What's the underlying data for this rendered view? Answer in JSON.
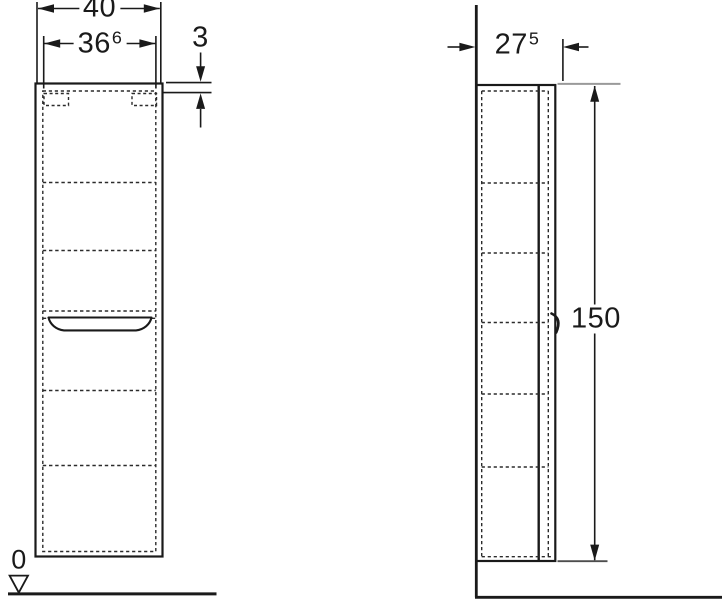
{
  "drawing": {
    "type": "furniture-technical-drawing",
    "colors": {
      "line": "#1a1a1a",
      "dashed_line": "#2b2b2b",
      "extension_gray": "#9a9a9a",
      "background": "#ffffff"
    }
  },
  "dimensions": {
    "overall_width": {
      "value": "40",
      "sup": ""
    },
    "door_width": {
      "value": "36",
      "sup": "6"
    },
    "top_panel": {
      "value": "3",
      "sup": ""
    },
    "depth": {
      "value": "27",
      "sup": "5"
    },
    "height": {
      "value": "150",
      "sup": ""
    },
    "floor_level": {
      "value": "0",
      "sup": ""
    }
  }
}
